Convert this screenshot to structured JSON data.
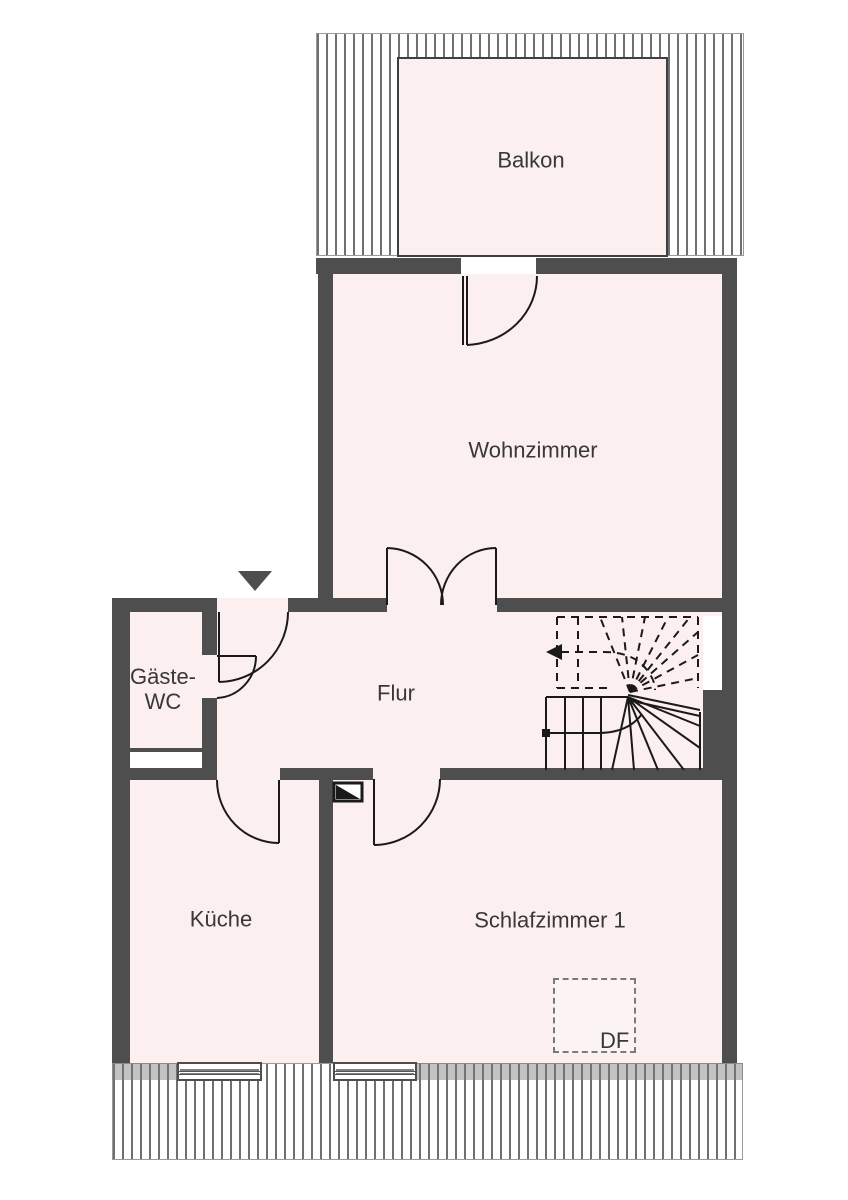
{
  "plan": {
    "type": "floor-plan",
    "floor_hint": "Dachgeschoss (roof windows and eaves hatching shown)"
  },
  "rooms": {
    "balkon": {
      "label": "Balkon"
    },
    "wohnzimmer": {
      "label": "Wohnzimmer"
    },
    "gaeste_wc": {
      "label_line1": "Gäste-",
      "label_line2": "WC"
    },
    "flur": {
      "label": "Flur"
    },
    "kueche": {
      "label": "Küche"
    },
    "schlafzimmer1": {
      "label": "Schlafzimmer 1"
    },
    "dachfenster": {
      "label": "DF"
    }
  },
  "symbols": {
    "entrance_arrow": "down-triangle entrance marker",
    "stair_direction": "dashed arrow pointing left (up-run above cut plane)",
    "chimney": "rectangle with black diagonal half",
    "windows": 3,
    "doors": 6
  },
  "colors": {
    "wall": "#4e4e4e",
    "room_fill": "#fcefef",
    "line": "#1a1a1a",
    "background": "#ffffff",
    "hatch_line": "#707070",
    "text": "#383838"
  }
}
